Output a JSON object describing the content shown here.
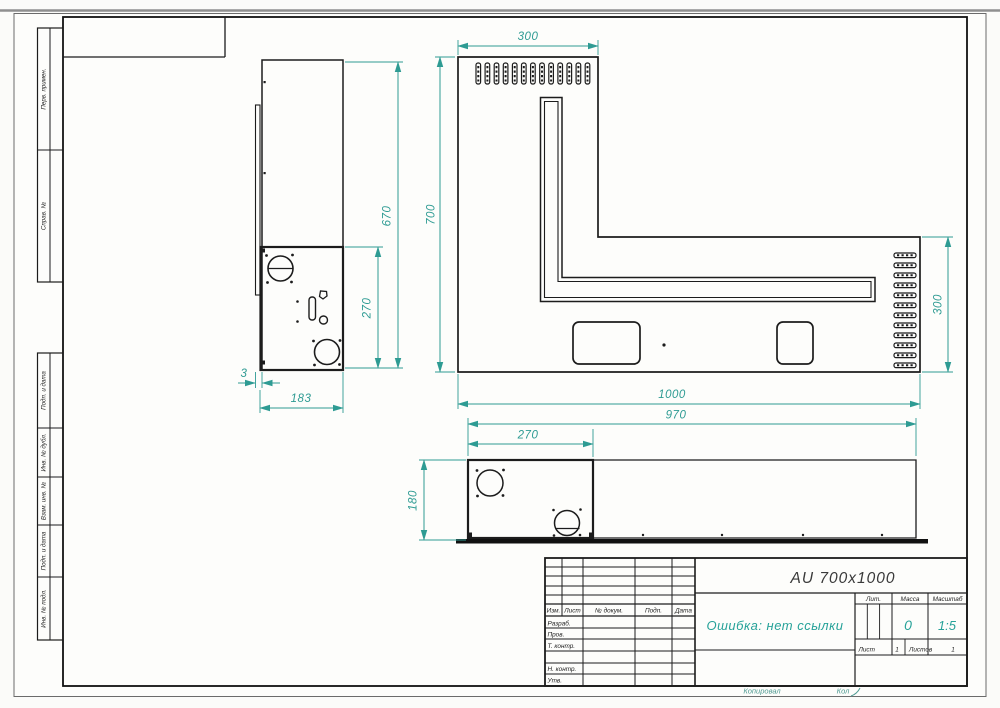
{
  "stamps": {
    "left_top": [
      "Перв. примен.",
      "Справ. №"
    ],
    "left_bottom": [
      "Подп. и дата",
      "Инв. № дубл.",
      "Взам. инв. №",
      "Подп. и дата",
      "Инв. № подл."
    ]
  },
  "title_block": {
    "doc_code": "AU 700x1000",
    "name": "Ошибка: нет ссылки",
    "header_cols": [
      "Изм.",
      "Лист",
      "№ докум.",
      "Подп.",
      "Дата"
    ],
    "sign_rows": [
      "Разраб.",
      "Пров.",
      "Т. контр.",
      "Н. контр.",
      "Утв."
    ],
    "lit_label": "Лит.",
    "mass_label": "Масса",
    "mass_value": "0",
    "scale_label": "Масштаб",
    "scale_value": "1:5",
    "sheet_label": "Лист",
    "sheet_value": "1",
    "sheets_label": "Листов",
    "sheets_value": "1",
    "copied_label": "Копировал",
    "format_label": "Кол"
  },
  "dims": {
    "plan": {
      "top_width": "300",
      "left_height": "700",
      "right_height": "300",
      "total_width": "1000",
      "body_width": "970"
    },
    "side": {
      "total_height": "670",
      "lower_height": "270",
      "thickness": "3",
      "depth": "183"
    },
    "front": {
      "box_width": "270",
      "height": "180"
    }
  },
  "colors": {
    "dimension": "#2e9b93",
    "accent_text": "#27a299",
    "drawing_line": "#1c1c1c"
  }
}
